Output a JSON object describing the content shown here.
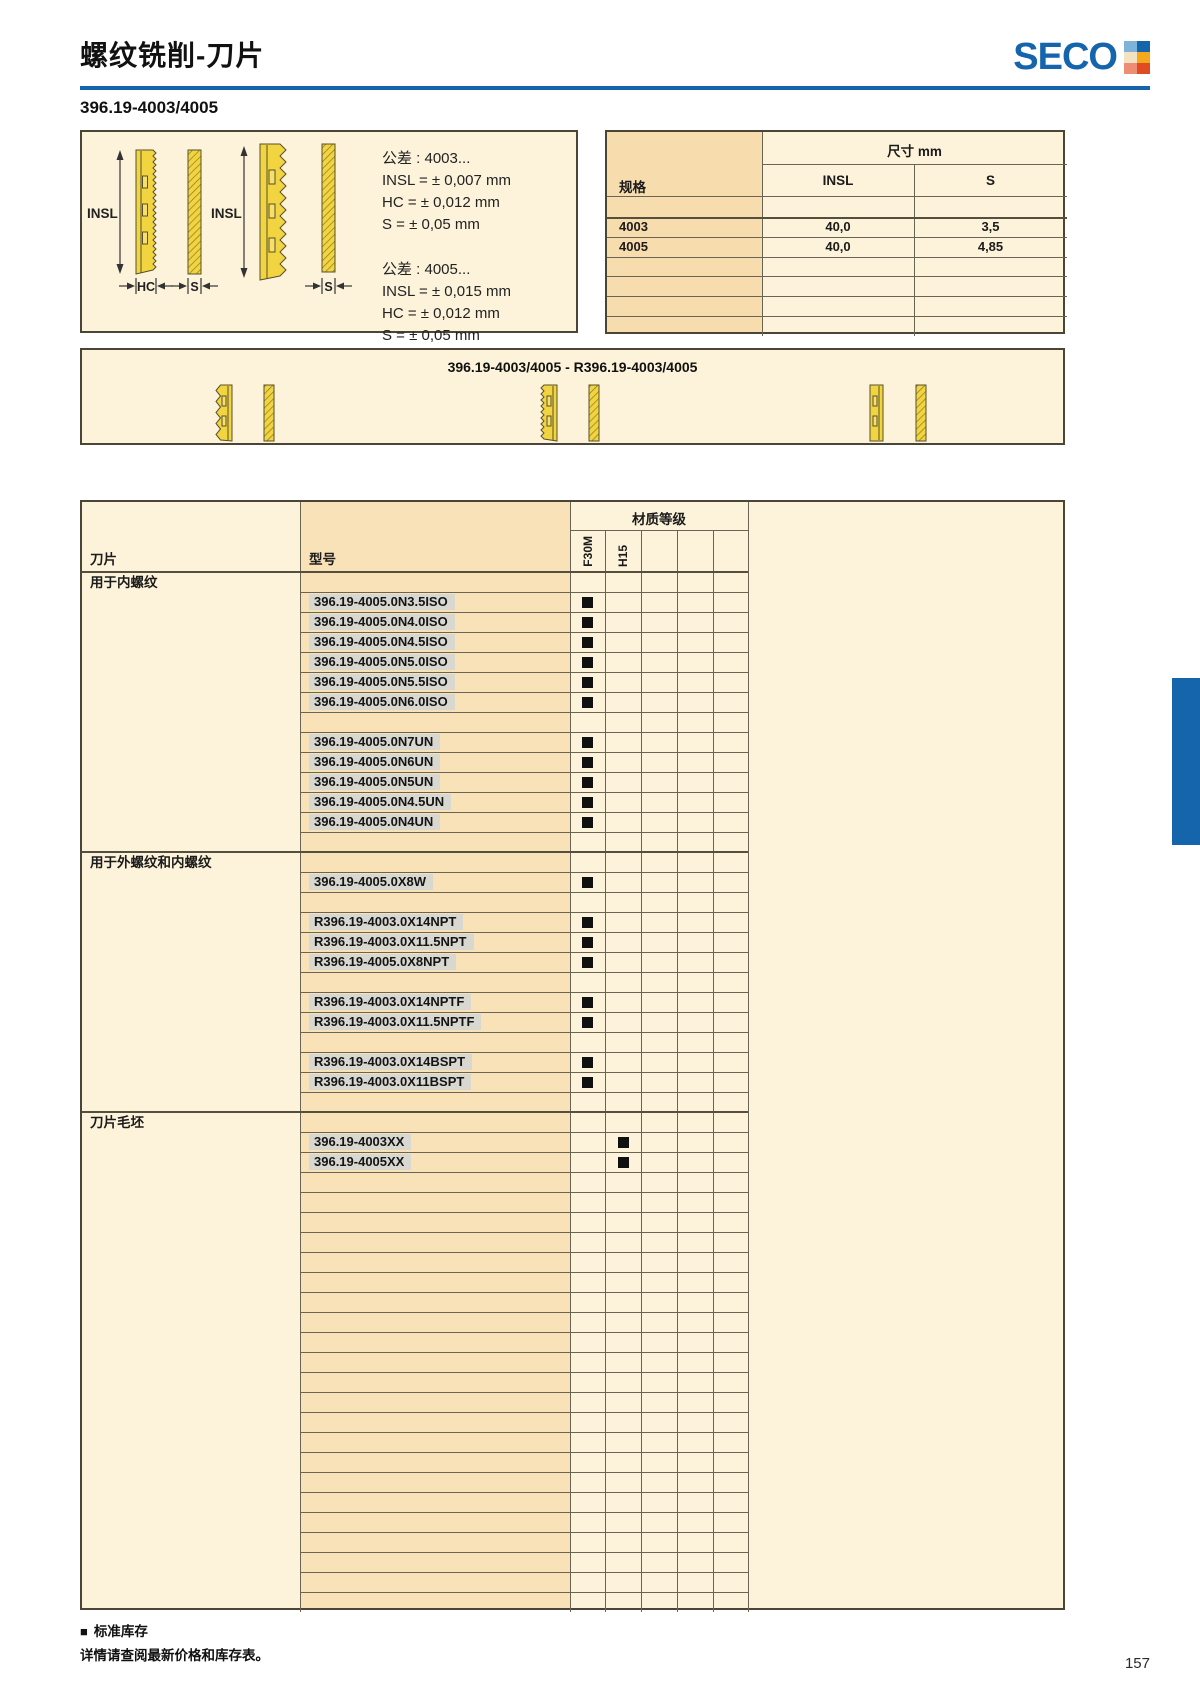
{
  "header": {
    "title": "螺纹铣削-刀片",
    "section": "396.19-4003/4005",
    "page_number": "157"
  },
  "logo": {
    "text": "SECO",
    "squares": [
      "#7fb2d9",
      "#1565ad",
      "#f3e3c3",
      "#f5a81c",
      "#ef8d74",
      "#e04b23"
    ]
  },
  "tolerance_box": {
    "labels": {
      "insl": "INSL",
      "hc": "HC",
      "s": "S"
    },
    "blocks": [
      {
        "title": "公差 : 4003...",
        "lines": [
          "INSL = ± 0,007 mm",
          "HC = ± 0,012 mm",
          "S = ± 0,05 mm"
        ]
      },
      {
        "title": "公差 : 4005...",
        "lines": [
          "INSL = ± 0,015 mm",
          "HC = ± 0,012 mm",
          "S = ± 0,05 mm"
        ]
      }
    ]
  },
  "spec_table": {
    "spec_col": "规格",
    "dim_header": "尺寸 mm",
    "columns": [
      "INSL",
      "S"
    ],
    "rows": [
      {
        "spec": "",
        "insl": "",
        "s": ""
      },
      {
        "spec": "4003",
        "insl": "40,0",
        "s": "3,5"
      },
      {
        "spec": "4005",
        "insl": "40,0",
        "s": "4,85"
      },
      {
        "spec": "",
        "insl": "",
        "s": ""
      },
      {
        "spec": "",
        "insl": "",
        "s": ""
      },
      {
        "spec": "",
        "insl": "",
        "s": ""
      },
      {
        "spec": "",
        "insl": "",
        "s": ""
      }
    ]
  },
  "banner": {
    "title": "396.19-4003/4005 - R396.19-4003/4005"
  },
  "main_table": {
    "insert_col": "刀片",
    "model_col": "型号",
    "grade_header": "材质等级",
    "grade_columns": [
      "F30M",
      "H15",
      "",
      "",
      ""
    ],
    "rows": [
      {
        "t": "group",
        "label": "用于内螺纹"
      },
      {
        "t": "model",
        "model": "396.19-4005.0N3.5ISO",
        "grade": "F30M"
      },
      {
        "t": "model",
        "model": "396.19-4005.0N4.0ISO",
        "grade": "F30M"
      },
      {
        "t": "model",
        "model": "396.19-4005.0N4.5ISO",
        "grade": "F30M"
      },
      {
        "t": "model",
        "model": "396.19-4005.0N5.0ISO",
        "grade": "F30M"
      },
      {
        "t": "model",
        "model": "396.19-4005.0N5.5ISO",
        "grade": "F30M"
      },
      {
        "t": "model",
        "model": "396.19-4005.0N6.0ISO",
        "grade": "F30M"
      },
      {
        "t": "empty"
      },
      {
        "t": "model",
        "model": "396.19-4005.0N7UN",
        "grade": "F30M"
      },
      {
        "t": "model",
        "model": "396.19-4005.0N6UN",
        "grade": "F30M"
      },
      {
        "t": "model",
        "model": "396.19-4005.0N5UN",
        "grade": "F30M"
      },
      {
        "t": "model",
        "model": "396.19-4005.0N4.5UN",
        "grade": "F30M"
      },
      {
        "t": "model",
        "model": "396.19-4005.0N4UN",
        "grade": "F30M"
      },
      {
        "t": "empty"
      },
      {
        "t": "group",
        "label": "用于外螺纹和内螺纹"
      },
      {
        "t": "model",
        "model": "396.19-4005.0X8W",
        "grade": "F30M"
      },
      {
        "t": "empty"
      },
      {
        "t": "model",
        "model": "R396.19-4003.0X14NPT",
        "grade": "F30M"
      },
      {
        "t": "model",
        "model": "R396.19-4003.0X11.5NPT",
        "grade": "F30M"
      },
      {
        "t": "model",
        "model": "R396.19-4005.0X8NPT",
        "grade": "F30M"
      },
      {
        "t": "empty"
      },
      {
        "t": "model",
        "model": "R396.19-4003.0X14NPTF",
        "grade": "F30M"
      },
      {
        "t": "model",
        "model": "R396.19-4003.0X11.5NPTF",
        "grade": "F30M"
      },
      {
        "t": "empty"
      },
      {
        "t": "model",
        "model": "R396.19-4003.0X14BSPT",
        "grade": "F30M"
      },
      {
        "t": "model",
        "model": "R396.19-4003.0X11BSPT",
        "grade": "F30M"
      },
      {
        "t": "empty"
      },
      {
        "t": "group",
        "label": "刀片毛坯"
      },
      {
        "t": "model",
        "model": "396.19-4003XX",
        "grade": "H15"
      },
      {
        "t": "model",
        "model": "396.19-4005XX",
        "grade": "H15"
      },
      {
        "t": "empty"
      },
      {
        "t": "empty"
      },
      {
        "t": "empty"
      },
      {
        "t": "empty"
      },
      {
        "t": "empty"
      },
      {
        "t": "empty"
      },
      {
        "t": "empty"
      },
      {
        "t": "empty"
      },
      {
        "t": "empty"
      },
      {
        "t": "empty"
      },
      {
        "t": "empty"
      },
      {
        "t": "empty"
      },
      {
        "t": "empty"
      },
      {
        "t": "empty"
      },
      {
        "t": "empty"
      },
      {
        "t": "empty"
      },
      {
        "t": "empty"
      },
      {
        "t": "empty"
      },
      {
        "t": "empty"
      },
      {
        "t": "empty"
      },
      {
        "t": "empty"
      },
      {
        "t": "empty"
      }
    ]
  },
  "footer": {
    "legend_marker": "■",
    "legend_text": "标准库存",
    "note": "详情请查阅最新价格和库存表。"
  },
  "colors": {
    "accent_blue": "#1565ad",
    "cream": "#fdf3da",
    "tan": "#f9e1b8",
    "bar_gray": "#d9d8d0",
    "insert_yellow": "#f2d340"
  }
}
